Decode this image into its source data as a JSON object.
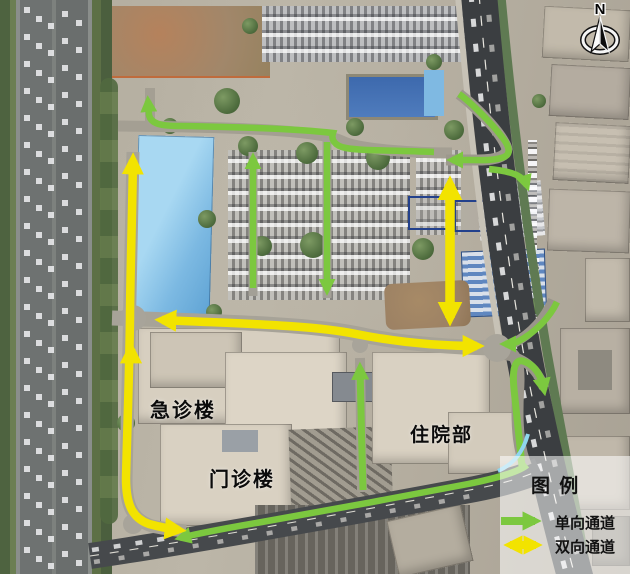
{
  "map": {
    "building_labels": [
      {
        "id": "emergency-building",
        "text": "急诊楼"
      },
      {
        "id": "outpatient-building",
        "text": "门诊楼"
      },
      {
        "id": "inpatient-building",
        "text": "住院部"
      }
    ],
    "compass": {
      "label": "N"
    },
    "legend": {
      "title": "图 例",
      "items": [
        {
          "symbol": "single-headed-arrow",
          "color": "one_way_green",
          "label": "单向通道"
        },
        {
          "symbol": "double-headed-arrow",
          "color": "two_way_yellow",
          "label": "双向通道"
        }
      ]
    }
  },
  "colors": {
    "one_way_green": "#7cc83f",
    "two_way_yellow": "#f2e300",
    "trace_cyan": "#8fd6ef",
    "label_text": "#0b0b0b"
  },
  "routes": {
    "paths": [
      {
        "name": "exit-northwest",
        "color": "one_way_green",
        "width": 6.5,
        "d": "M434,152 C390,150 362,151 346,148 C334,146 331,139 333,133 C300,129 240,127 180,126 C161,126 151,124 149,115 L148,101",
        "head_end": true
      },
      {
        "name": "entry-northeast",
        "color": "one_way_green",
        "width": 6.5,
        "d": "M459,94 C468,100 490,121 502,137 C510,147 511,154 504,157 C495,161 478,160 468,160 L452,160",
        "head_end": true
      },
      {
        "name": "parking-lane-southbound",
        "color": "one_way_green",
        "width": 6.5,
        "d": "M327,142 L327,290",
        "head_end": true
      },
      {
        "name": "parking-lane-northbound",
        "color": "one_way_green",
        "width": 6.5,
        "d": "M253,288 L253,158",
        "head_end": true
      },
      {
        "name": "inner-drive-northbound",
        "color": "one_way_green",
        "width": 7,
        "d": "M363,490 C362,450 361,420 360,368",
        "head_end": true
      },
      {
        "name": "exit-northeast",
        "color": "one_way_green",
        "width": 6.5,
        "d": "M489,169 C499,170 513,172 520,177 C524,180 526,183 527,186",
        "head_end": true
      },
      {
        "name": "entry-east",
        "color": "one_way_green",
        "width": 6.5,
        "d": "M557,302 C550,317 535,333 517,342 C513,344 509,344 505,344",
        "head_end": true
      },
      {
        "name": "exit-east-arch",
        "color": "one_way_green",
        "width": 7,
        "d": "M522,466 C519,438 516,410 514,389 C512,369 515,359 523,361 C533,364 540,373 543,385 L544,390",
        "head_end": true
      },
      {
        "name": "exit-southwest",
        "color": "one_way_green",
        "width": 6.5,
        "d": "M527,465 C520,471 498,478 468,484 C400,497 330,510 262,522 C227,528 196,534 180,538",
        "head_end": true
      },
      {
        "name": "west-loop",
        "color": "two_way_yellow",
        "width": 8.5,
        "d": "M133,160 C132,225 130,285 130,318 C129,385 127,437 126,478 C126,504 132,518 149,524 C160,527 170,529 179,530",
        "head_start": true,
        "head_end": true
      },
      {
        "name": "west-loop-mid-arrow",
        "color": "two_way_yellow",
        "width": 8.5,
        "d": "M131,358 L131,349",
        "head_end": true
      },
      {
        "name": "central-avenue",
        "color": "two_way_yellow",
        "width": 8.5,
        "d": "M162,320 C245,324 312,325 356,334 C401,343 444,346 477,346",
        "head_start": true,
        "head_end": true
      },
      {
        "name": "north-south-lane",
        "color": "two_way_yellow",
        "width": 9.5,
        "d": "M450,184 L450,318",
        "head_start": true,
        "head_end": true
      },
      {
        "name": "riverside-trace",
        "color": "trace_cyan",
        "width": 4,
        "d": "M528,434 C523,452 514,464 498,471"
      }
    ]
  }
}
